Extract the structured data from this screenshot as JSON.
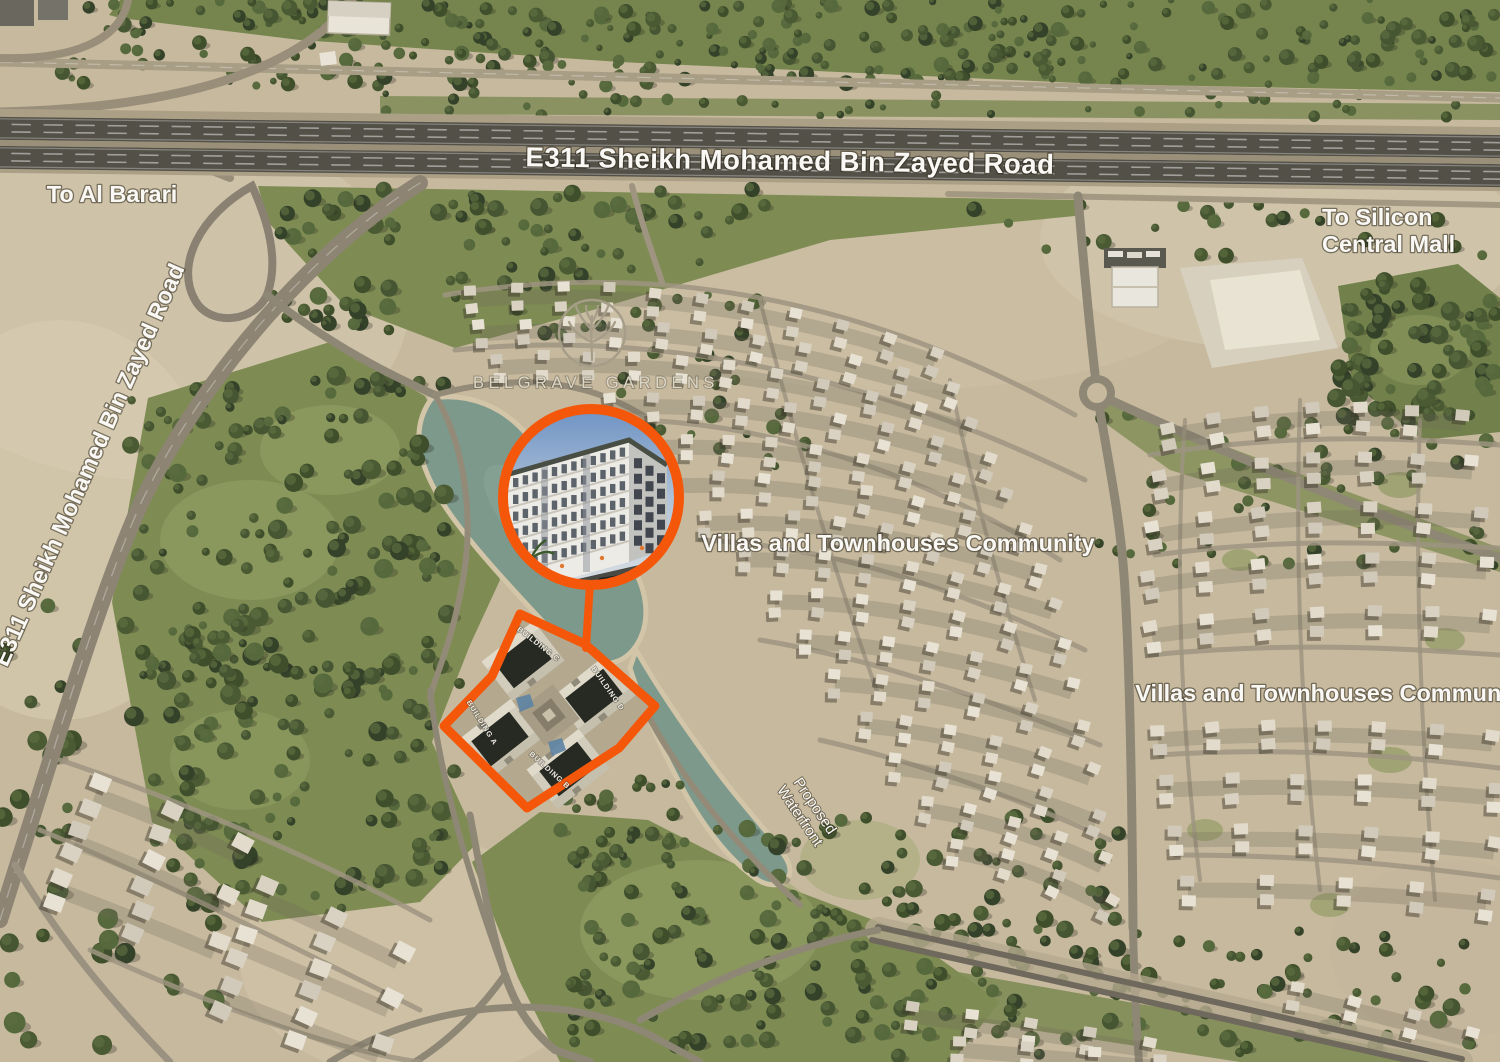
{
  "meta": {
    "type": "project-location-aerial-map"
  },
  "colors": {
    "accent": "#F4570A",
    "water": "#7D998C",
    "sand": "#C6B99E",
    "greenery": "#7E8C54"
  },
  "labels": {
    "e311_top": "E311 Sheikh Mohamed Bin Zayed Road",
    "e311_left": "E311 Sheikh Mohamed Bin Zayed Road",
    "to_al_barari": "To Al Barari",
    "to_silicon_line1": "To Silicon",
    "to_silicon_line2": "Central Mall",
    "villas_center": "Villas and Townhouses Community",
    "villas_right": "Villas and Townhouses Community",
    "waterfront_line1": "Proposed",
    "waterfront_line2": "Waterfront"
  },
  "brand": {
    "name": "BELGRAVE GARDENS"
  },
  "site": {
    "building_labels": [
      "BUILDING A",
      "BUILDING B",
      "BUILDING C",
      "BUILDING D"
    ]
  }
}
